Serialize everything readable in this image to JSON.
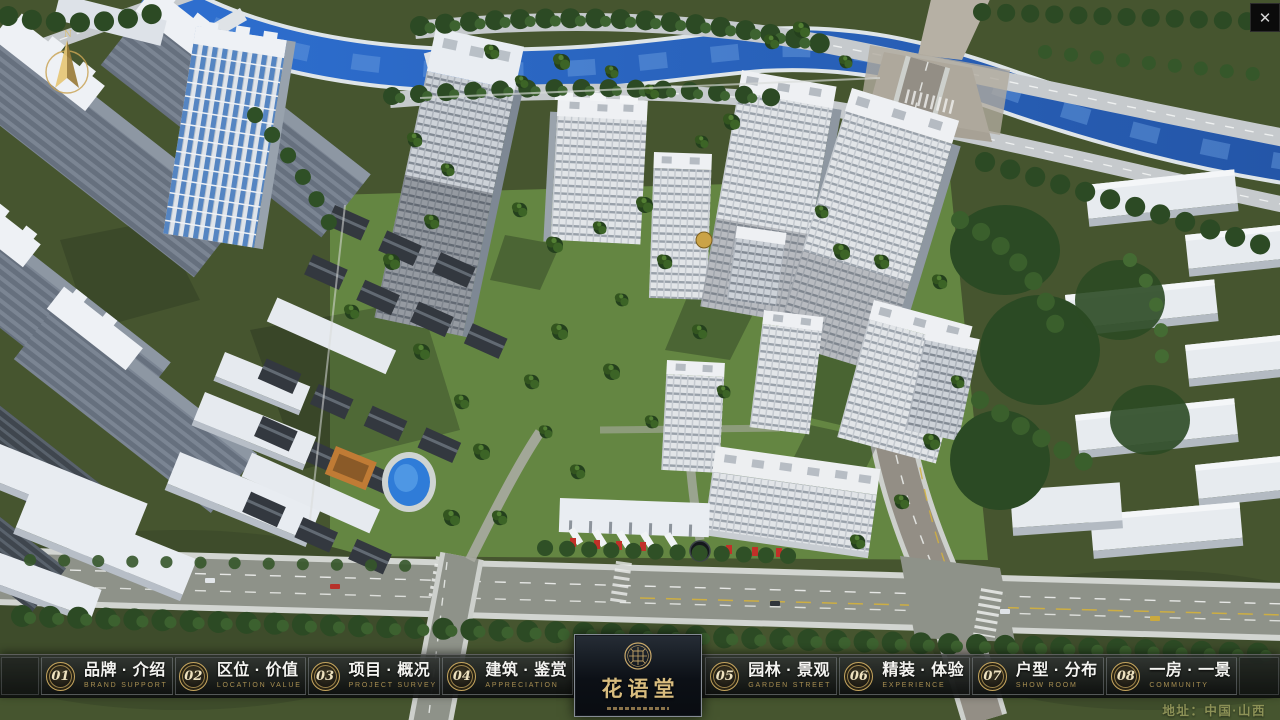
{
  "ui": {
    "window": {
      "close_label": "✕"
    },
    "compass": {
      "label": "N"
    },
    "menu": [
      {
        "num": "01",
        "zh": "品牌 · 介绍",
        "en": "BRAND SUPPORT"
      },
      {
        "num": "02",
        "zh": "区位 · 价值",
        "en": "LOCATION VALUE"
      },
      {
        "num": "03",
        "zh": "项目 · 概况",
        "en": "PROJECT SURVEY"
      },
      {
        "num": "04",
        "zh": "建筑 · 鉴赏",
        "en": "APPRECIATION"
      },
      {
        "num": "05",
        "zh": "园林 · 景观",
        "en": "GARDEN STREET"
      },
      {
        "num": "06",
        "zh": "精装 · 体验",
        "en": "EXPERIENCE"
      },
      {
        "num": "07",
        "zh": "户型 · 分布",
        "en": "SHOW ROOM"
      },
      {
        "num": "08",
        "zh": "一房 · 一景",
        "en": "COMMUNITY"
      }
    ],
    "logo": {
      "title": "花语堂"
    },
    "footer": {
      "address": "地址：中国·山西"
    }
  },
  "colors": {
    "gold": "#c9a45e",
    "river": "#2c63c4",
    "bar_bg": "#14171a"
  }
}
